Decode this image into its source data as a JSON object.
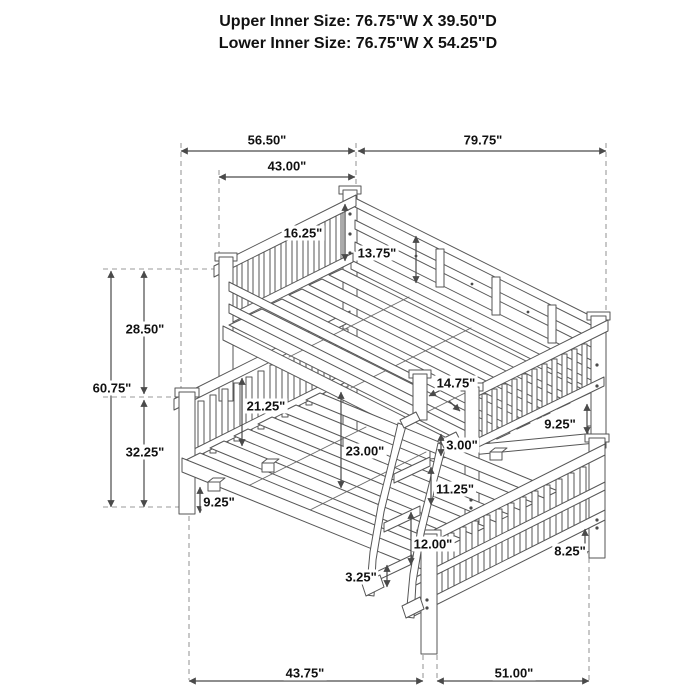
{
  "page": {
    "background": "#ffffff",
    "line_color": "#4a4a4a",
    "text_color": "#111111"
  },
  "title": {
    "upper": "Upper Inner Size: 76.75\"W X 39.50\"D",
    "lower": "Lower Inner Size: 76.75\"W X 54.25\"D"
  },
  "dimensions": {
    "d56_50": "56.50\"",
    "d79_75": "79.75\"",
    "d43_00": "43.00\"",
    "d16_25": "16.25\"",
    "d13_75": "13.75\"",
    "d28_50": "28.50\"",
    "d60_75": "60.75\"",
    "d32_25": "32.25\"",
    "d14_75": "14.75\"",
    "d21_25": "21.25\"",
    "d9_25_right": "9.25\"",
    "d23_00": "23.00\"",
    "d3_00": "3.00\"",
    "d11_25": "11.25\"",
    "d9_25_left": "9.25\"",
    "d12_00": "12.00\"",
    "d8_25": "8.25\"",
    "d3_25": "3.25\"",
    "d43_75": "43.75\"",
    "d51_00": "51.00\""
  }
}
